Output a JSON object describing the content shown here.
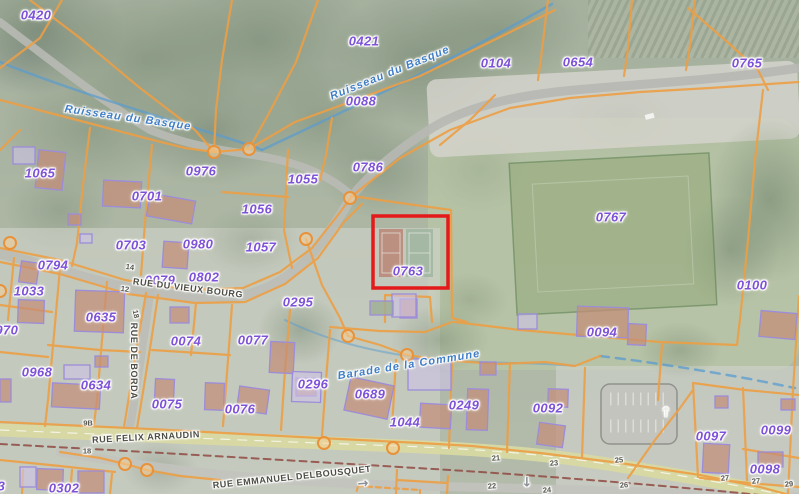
{
  "map": {
    "description": "Cadastral parcel map over aerial photo",
    "highlight": {
      "parcel_id": "0763",
      "color": "#E41A1A"
    },
    "colors": {
      "parcel_line": "#ED9F45",
      "parcel_label": "#7E52D8",
      "street_label": "#4C4C44",
      "water_label": "#3F7EC6",
      "house_number": "#55564E",
      "building_fill": "#C48E78",
      "building_stroke": "#9C8CD9",
      "main_road_fill": "#D8D9A2",
      "boundary_dash": "#8F4A42"
    },
    "parcels": [
      {
        "id": "0420",
        "x": 36,
        "y": 15
      },
      {
        "id": "0421",
        "x": 364,
        "y": 41
      },
      {
        "id": "0104",
        "x": 496,
        "y": 63
      },
      {
        "id": "0654",
        "x": 578,
        "y": 62
      },
      {
        "id": "0765",
        "x": 747,
        "y": 63
      },
      {
        "id": "0088",
        "x": 361,
        "y": 101
      },
      {
        "id": "1065",
        "x": 40,
        "y": 173
      },
      {
        "id": "0976",
        "x": 201,
        "y": 171
      },
      {
        "id": "1055",
        "x": 303,
        "y": 179
      },
      {
        "id": "0786",
        "x": 368,
        "y": 167
      },
      {
        "id": "0701",
        "x": 147,
        "y": 196
      },
      {
        "id": "1056",
        "x": 257,
        "y": 209
      },
      {
        "id": "0703",
        "x": 131,
        "y": 245
      },
      {
        "id": "0980",
        "x": 198,
        "y": 244
      },
      {
        "id": "1057",
        "x": 261,
        "y": 247
      },
      {
        "id": "0794",
        "x": 53,
        "y": 265
      },
      {
        "id": "0079",
        "x": 160,
        "y": 280
      },
      {
        "id": "0802",
        "x": 204,
        "y": 277
      },
      {
        "id": "1033",
        "x": 29,
        "y": 291
      },
      {
        "id": "0295",
        "x": 298,
        "y": 302
      },
      {
        "id": "0763",
        "x": 408,
        "y": 271
      },
      {
        "id": "0767",
        "x": 611,
        "y": 217
      },
      {
        "id": "0100",
        "x": 752,
        "y": 285
      },
      {
        "id": "0970",
        "x": 3,
        "y": 330
      },
      {
        "id": "0635",
        "x": 101,
        "y": 317
      },
      {
        "id": "0094",
        "x": 602,
        "y": 332
      },
      {
        "id": "0074",
        "x": 186,
        "y": 341
      },
      {
        "id": "0077",
        "x": 253,
        "y": 340
      },
      {
        "id": "0968",
        "x": 37,
        "y": 372
      },
      {
        "id": "0634",
        "x": 96,
        "y": 385
      },
      {
        "id": "0296",
        "x": 313,
        "y": 384
      },
      {
        "id": "0689",
        "x": 370,
        "y": 394
      },
      {
        "id": "0075",
        "x": 167,
        "y": 404
      },
      {
        "id": "0076",
        "x": 240,
        "y": 409
      },
      {
        "id": "1044",
        "x": 405,
        "y": 422
      },
      {
        "id": "0249",
        "x": 464,
        "y": 405
      },
      {
        "id": "0092",
        "x": 548,
        "y": 408
      },
      {
        "id": "0097",
        "x": 711,
        "y": 436
      },
      {
        "id": "0099",
        "x": 776,
        "y": 430
      },
      {
        "id": "0098",
        "x": 765,
        "y": 469
      },
      {
        "id": "0303",
        "x": -10,
        "y": 486
      },
      {
        "id": "0302",
        "x": 64,
        "y": 488
      }
    ],
    "streets": [
      {
        "name": "RUE DU VIEUX BOURG",
        "x": 188,
        "y": 288,
        "rot": 7
      },
      {
        "name": "RUE DE BORDA",
        "x": 134,
        "y": 361,
        "rot": 90
      },
      {
        "name": "RUE FELIX ARNAUDIN",
        "x": 146,
        "y": 437,
        "rot": -3
      },
      {
        "name": "RUE EMMANUEL DELBOUSQUET",
        "x": 292,
        "y": 477,
        "rot": -6
      }
    ],
    "waterways": [
      {
        "name": "Ruisseau du Basque",
        "x": 128,
        "y": 118,
        "rot": 8
      },
      {
        "name": "Ruisseau du Basque",
        "x": 390,
        "y": 73,
        "rot": -22
      },
      {
        "name": "Barade de la Commune",
        "x": 409,
        "y": 365,
        "rot": -9
      }
    ],
    "house_numbers": [
      {
        "n": "14",
        "x": 130,
        "y": 267,
        "rot": 8
      },
      {
        "n": "12",
        "x": 125,
        "y": 289,
        "rot": 8
      },
      {
        "n": "18",
        "x": 136,
        "y": 314,
        "rot": 78
      },
      {
        "n": "9B",
        "x": 88,
        "y": 423,
        "rot": 0
      },
      {
        "n": "18",
        "x": 87,
        "y": 451,
        "rot": 0
      },
      {
        "n": "21",
        "x": 496,
        "y": 458,
        "rot": -4
      },
      {
        "n": "23",
        "x": 554,
        "y": 463,
        "rot": -4
      },
      {
        "n": "22",
        "x": 492,
        "y": 486,
        "rot": -4
      },
      {
        "n": "24",
        "x": 547,
        "y": 490,
        "rot": -4
      },
      {
        "n": "25",
        "x": 619,
        "y": 460,
        "rot": -4
      },
      {
        "n": "26",
        "x": 624,
        "y": 485,
        "rot": -4
      },
      {
        "n": "27",
        "x": 725,
        "y": 478,
        "rot": -4
      },
      {
        "n": "27",
        "x": 756,
        "y": 481,
        "rot": -4
      },
      {
        "n": "29",
        "x": 789,
        "y": 484,
        "rot": -4
      }
    ],
    "icons": [
      {
        "name": "one-way-right-arrow",
        "glyph": "→",
        "x": 363,
        "y": 484,
        "rot": -5,
        "color": "#8A8F96"
      },
      {
        "name": "one-way-down-arrow",
        "glyph": "↓",
        "x": 527,
        "y": 483,
        "rot": 0,
        "color": "#8A8F96"
      },
      {
        "name": "parking-direction-arrow",
        "glyph": "↑",
        "x": 666,
        "y": 413,
        "rot": 0,
        "color": "#EDEDE8"
      }
    ]
  }
}
